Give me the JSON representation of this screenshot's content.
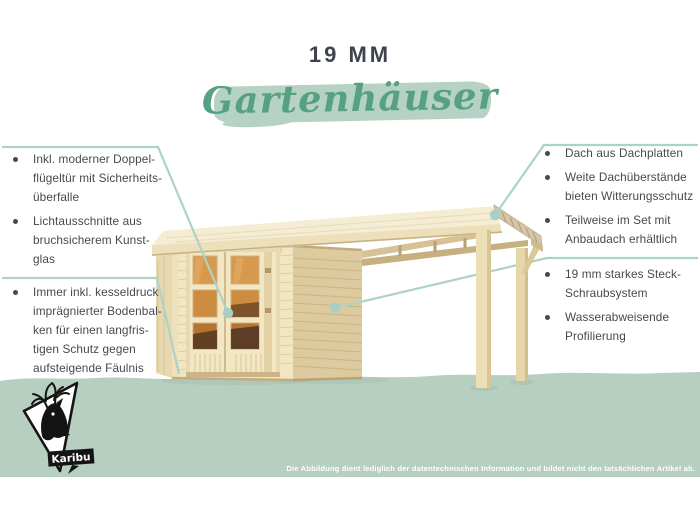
{
  "brand": {
    "name": "Karibu"
  },
  "header": {
    "size_label": "19 MM",
    "category_label": "Gartenhäuser"
  },
  "left_panel": {
    "items": [
      {
        "text": "Inkl. moderner Doppel-\nflügeltür mit Sicherheits-\nüberfalle"
      },
      {
        "text": "Lichtausschnitte aus\nbruchsicherem Kunst-\nglas"
      },
      {
        "text": "Immer inkl. kesseldruck\nimprägnierter Bodenbal-\nken für einen langfris-\ntigen Schutz gegen\naufsteigende Fäulnis"
      }
    ]
  },
  "right_panel": {
    "items": [
      {
        "text": "Dach aus Dachplatten"
      },
      {
        "text": "Weite Dachüberstände\nbieten Witterungsschutz"
      },
      {
        "text": "Teilweise im Set mit\nAnbaudach erhältlich"
      },
      {
        "text": "19 mm starkes Steck-\nSchraubsystem"
      },
      {
        "text": "Wasserabweisende\nProfilierung"
      }
    ]
  },
  "footer": {
    "disclaimer": "Die Abbildung dient lediglich der datentechnischen Information und bildet nicht den tatsächlichen Artikel ab."
  },
  "colors": {
    "title_text": "#3e434d",
    "body_text": "#45494f",
    "script_green": "#57a183",
    "brush_green": "#b5d2c4",
    "band_green": "#b6cfc1",
    "annotation_teal": "#abd3c7",
    "wood_light": "#f2e5c2",
    "wood_side": "#ddca9e",
    "glass_amber": "#c98a3f",
    "logo_black": "#141414",
    "disclaimer_text": "#ffffff"
  }
}
